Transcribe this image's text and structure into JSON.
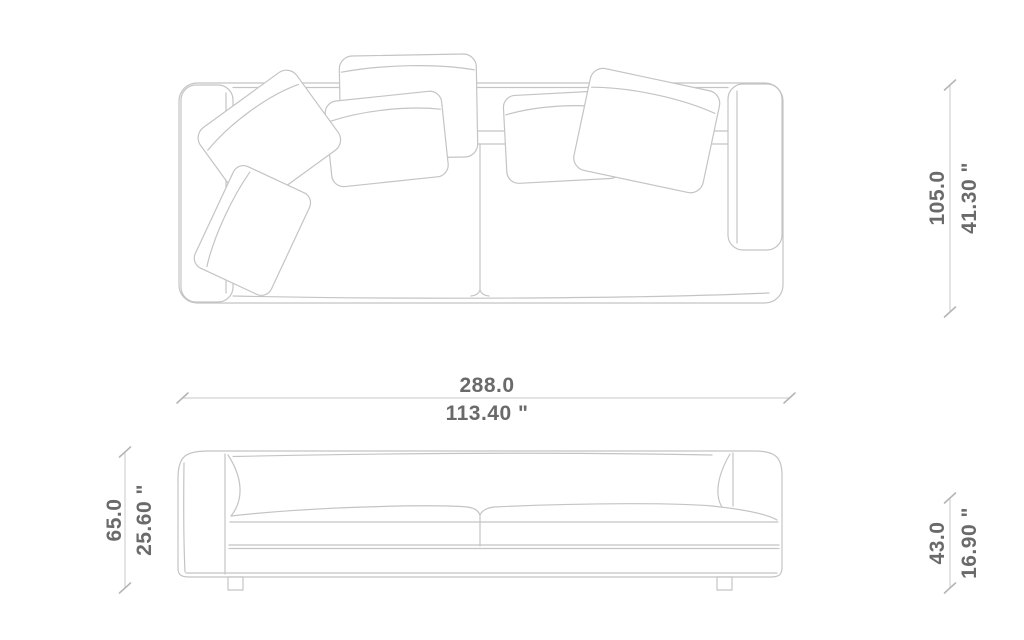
{
  "figure": {
    "title": "sofa-dimension-diagram",
    "views": {
      "top_view": {
        "label": "sofa top view with back cushions"
      },
      "front_view": {
        "label": "sofa front elevation"
      }
    },
    "dimensions": {
      "width": {
        "metric": "288.0",
        "imperial": "113.40 \""
      },
      "depth": {
        "metric": "105.0",
        "imperial": "41.30 \""
      },
      "height": {
        "metric": "65.0",
        "imperial": "25.60 \""
      },
      "seat_height": {
        "metric": "43.0",
        "imperial": "16.90 \""
      }
    },
    "colors": {
      "background": "#ffffff",
      "drawing_line": "#c4c4c4",
      "dimension_line": "#d2d2d2",
      "dimension_tick": "#b5b5b5",
      "dimension_text": "#6a6a6a"
    }
  }
}
